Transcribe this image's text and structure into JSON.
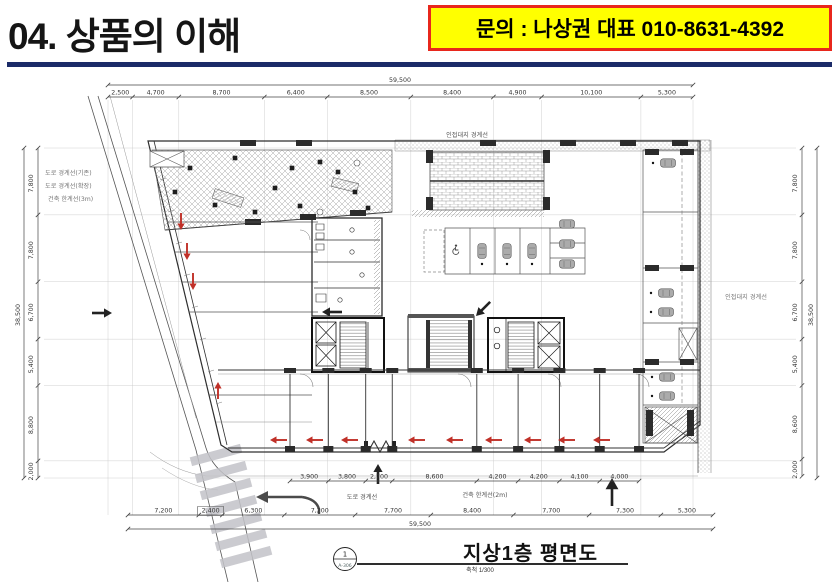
{
  "header": {
    "title": "04. 상품의 이해",
    "contact_banner": "문의 : 나상권 대표 010-8631-4392",
    "banner_bg": "#ffff00",
    "banner_border": "#e8271c",
    "rule_color": "#1b2b68"
  },
  "plan": {
    "caption": {
      "sheet_no": "1",
      "sheet_ref": "A-306",
      "title": "지상1층 평면도",
      "scale": "축척 1/300"
    },
    "dims": {
      "top": [
        "2,500",
        "4,700",
        "8,700",
        "6,400",
        "8,500",
        "8,400",
        "4,900",
        "10,100",
        "5,300"
      ],
      "top_total": "59,500",
      "bottom": [
        "7,200",
        "2,400",
        "6,300",
        "7,200",
        "7,700",
        "8,400",
        "7,700",
        "7,300",
        "5,300"
      ],
      "bottom_total": "59,500",
      "left": [
        "7,800",
        "7,800",
        "6,700",
        "5,400",
        "8,800",
        "2,000"
      ],
      "left_total": "38,500",
      "right": [
        "7,800",
        "7,800",
        "6,700",
        "5,400",
        "8,600",
        "2,000"
      ],
      "right_total": "38,500",
      "inner_bottom": [
        "3,900",
        "3,800",
        "2,700",
        "8,600",
        "4,200",
        "4,200",
        "4,100",
        "4,000"
      ]
    },
    "labels": {
      "road_existing": "도로 경계선(기존)",
      "road_extended": "도로 경계선(확장)",
      "building_limit_3m": "건축 한계선(3m)",
      "adjacent_top": "인접대지 경계선",
      "adjacent_right": "인접대지 경계선",
      "road_bottom": "도로 경계선",
      "building_limit_2m": "건축 한계선(2m)"
    },
    "colors": {
      "line": "#444",
      "red_arrow": "#c03028"
    }
  }
}
